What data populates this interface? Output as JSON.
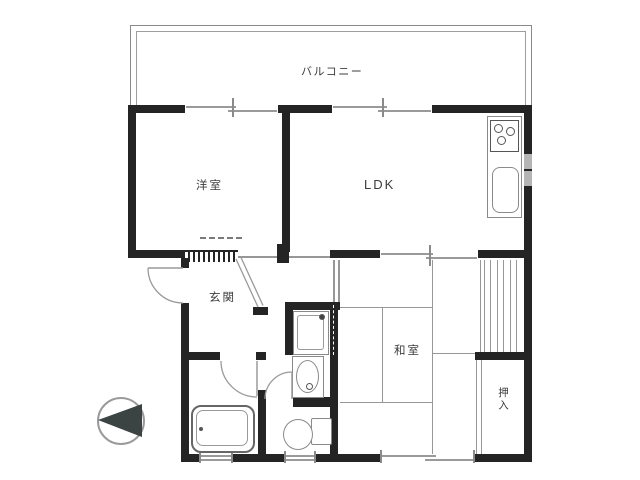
{
  "plan_title": "apartment-floor-plan",
  "labels": {
    "balcony": "バルコニー",
    "western_room": "洋室",
    "ldk": "LDK",
    "entrance": "玄関",
    "japanese_room": "和室",
    "closet": "押入"
  },
  "fixtures": {
    "kitchen_stove": "gas-stove-3-burner",
    "kitchen_sink": "kitchen-sink",
    "washing_machine": "washing-machine-pan",
    "washbasin": "washbasin",
    "bathtub": "bathtub",
    "toilet": "toilet",
    "compass": "north-arrow-pointing-left"
  },
  "colors": {
    "wall": "#242424",
    "thin_line": "#979797",
    "text": "#3c3c3c",
    "compass_fill": "#3c4343",
    "background": "#ffffff"
  }
}
